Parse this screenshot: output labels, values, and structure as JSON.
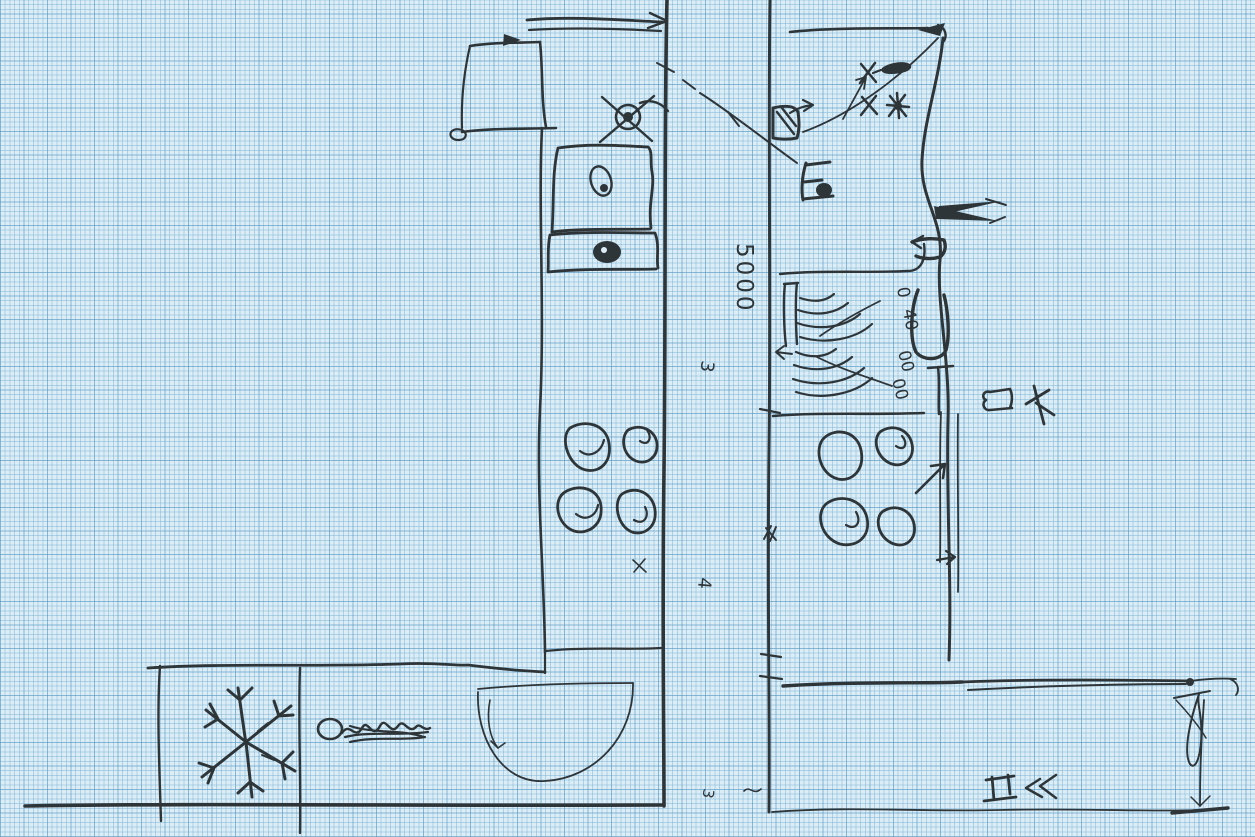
{
  "document": {
    "kind": "hand-drawn kitchen floor plan sketch, two parallel counter layouts",
    "medium": "ink pen on blue graph paper",
    "ink_color": "#2e3539",
    "paper_color": "#dcedf6",
    "grid_minor_color": "#7db4d6",
    "grid_major_color": "#468cb9"
  },
  "annotations": {
    "dim_5000": "5000",
    "num_3_upper": "3",
    "num_4_lower": "4",
    "num_3_corner": "3",
    "label_0": "0",
    "label_40": "40",
    "label_00_upper": "00",
    "label_00_lower": "00"
  },
  "symbols": {
    "left_plan": [
      "upper cabinet box",
      "ceiling lamp (crossed circle)",
      "two appliance boxes",
      "4-burner cooktop",
      "freezer snowflake",
      "scribbled word label",
      "quarter-round counter end with door-swing arrow"
    ],
    "right_plan": [
      "wall fixture with arrow",
      "hatched fan shelves",
      "4-burner cooktop",
      "dimension arrows",
      "loop and dimension line at bottom right"
    ]
  }
}
